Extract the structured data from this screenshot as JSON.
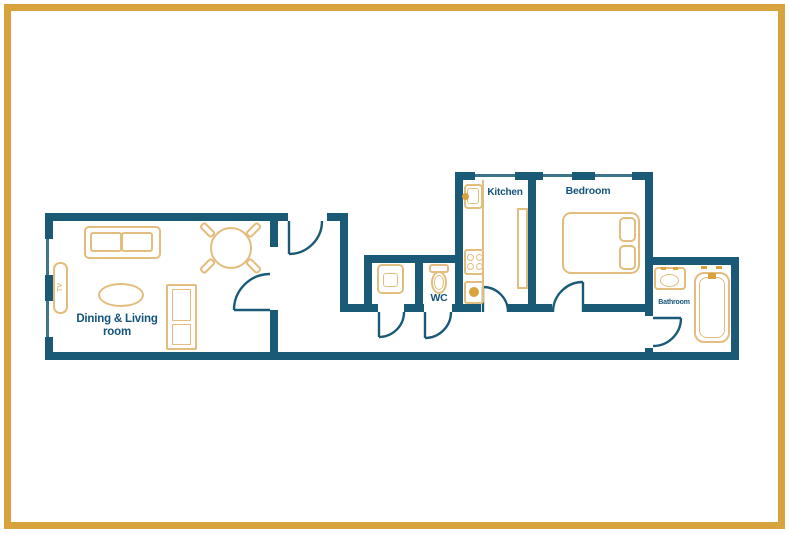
{
  "document": {
    "type": "apartment floor plan"
  },
  "colors": {
    "bg": "#ffffff",
    "wall": "#1b5a77",
    "text": "#15537b",
    "gold": "#e3bd7d",
    "gold-strong": "#d8a33c"
  },
  "rooms": {
    "living": {
      "name_line1": "Dining & Living",
      "name_line2": "room",
      "furniture": [
        "sofa",
        "dining table with 4 chairs",
        "coffee table",
        "cabinet",
        "TV"
      ]
    },
    "utility": {
      "furniture": [
        "washing machine"
      ]
    },
    "wc": {
      "name": "WC",
      "furniture": [
        "toilet"
      ]
    },
    "kitchen": {
      "name": "Kitchen",
      "furniture": [
        "sink",
        "counter",
        "stove",
        "oven",
        "side counter"
      ]
    },
    "bedroom": {
      "name": "Bedroom",
      "furniture": [
        "double bed with two pillows"
      ]
    },
    "bathroom": {
      "name": "Bathroom",
      "furniture": [
        "sink",
        "bathtub"
      ]
    }
  },
  "fixtures": {
    "tv_label": "TV"
  }
}
